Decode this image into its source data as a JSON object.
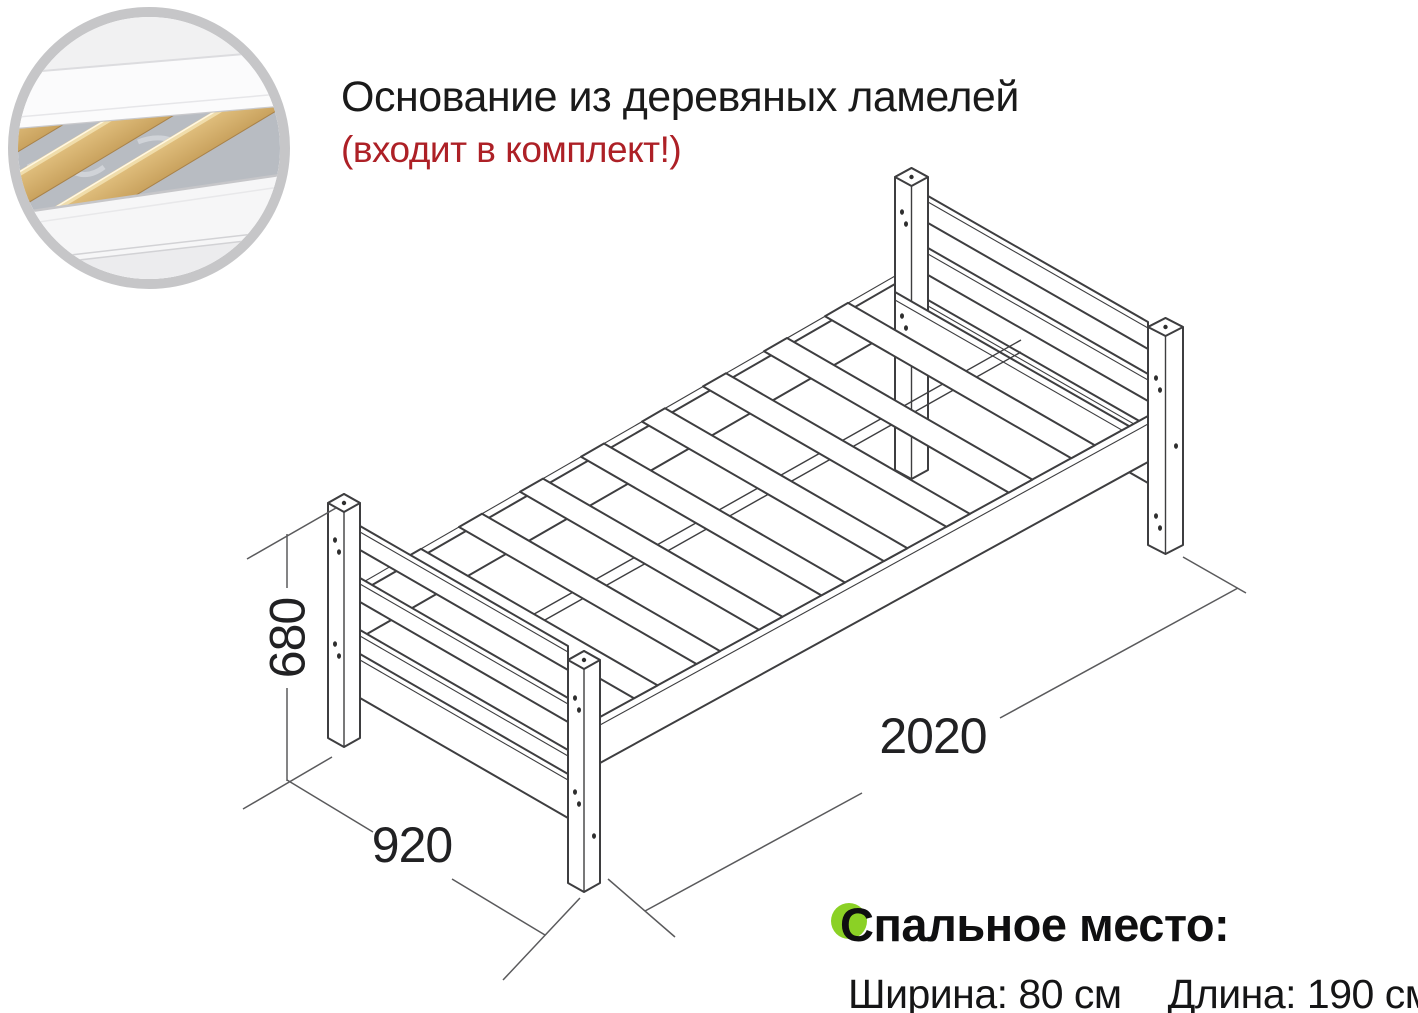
{
  "header": {
    "title": "Основание из деревяных ламелей",
    "note": "(входит в комплект!)"
  },
  "dimensions": {
    "height": "680",
    "width": "920",
    "length": "2020"
  },
  "sleeping": {
    "title": "Спальное место:",
    "width_label": "Ширина: 80 см",
    "length_label": "Длина: 190 см"
  },
  "colors": {
    "note_red": "#ad2026",
    "accent_green": "#8bd125",
    "ring_grey": "#c6c6c8",
    "drawing_line": "#3e3e40",
    "slat_wood": "#d8b572",
    "fabric_grey": "#b8bcc2"
  }
}
